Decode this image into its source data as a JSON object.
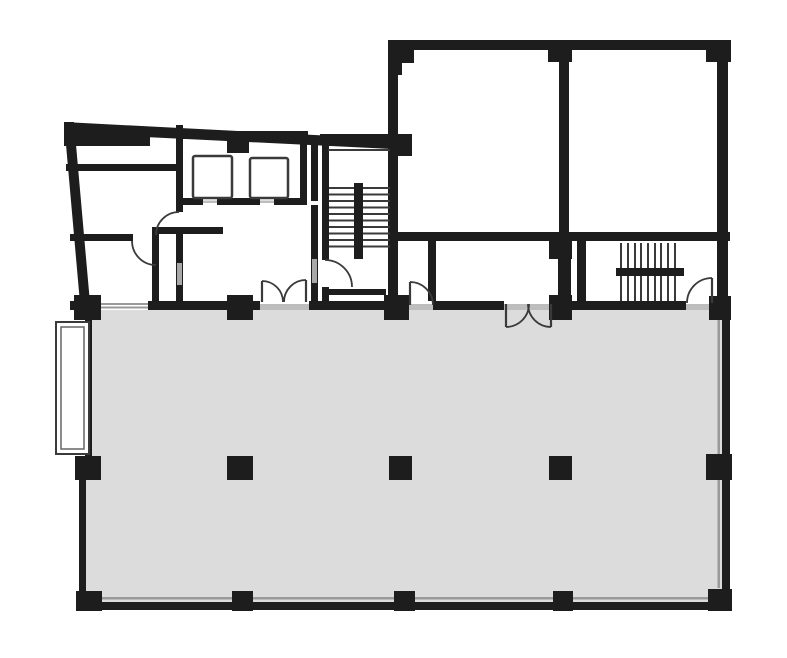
{
  "app": {
    "type": "architectural-floor-plan",
    "description": "Black-and-white building floor plan: upper room block with elevator core and two stairwells, large gray open-plan area below with structural column grid, door swing arcs and a bay window"
  },
  "canvas": {
    "width": 787,
    "height": 658,
    "background": "#ffffff"
  },
  "palette": {
    "wall": "#1d1d1d",
    "line": "#3a3a3a",
    "floor_fill": "#dcdcdc",
    "threshold": "#bdbdbd",
    "glass": "#9a9a9a",
    "marker": "#a8a8a8",
    "white": "#ffffff"
  },
  "plan": {
    "open_area": {
      "points": "88,303 728,303 728,607 80,607 80,470 88,468"
    },
    "slant_walls": [
      {
        "name": "exterior-top-left-wall",
        "points": "64,122 392,139 392,149 64,133"
      },
      {
        "name": "exterior-left-wall",
        "points": "64,122 74,122 90,303 80,303"
      }
    ],
    "walls": [
      [
        66,
        164,
        112,
        7
      ],
      [
        70,
        234,
        63,
        7
      ],
      [
        156,
        227,
        67,
        7
      ],
      [
        152,
        227,
        7,
        76
      ],
      [
        176,
        125,
        7,
        87
      ],
      [
        176,
        234,
        7,
        69
      ],
      [
        176,
        131,
        132,
        8
      ],
      [
        300,
        139,
        7,
        62
      ],
      [
        311,
        139,
        7,
        62
      ],
      [
        178,
        198,
        129,
        7
      ],
      [
        311,
        205,
        7,
        98
      ],
      [
        322,
        134,
        7,
        126
      ],
      [
        322,
        287,
        7,
        16
      ],
      [
        320,
        134,
        78,
        9
      ],
      [
        325,
        289,
        61,
        6
      ],
      [
        388,
        40,
        342,
        10
      ],
      [
        388,
        40,
        10,
        201
      ],
      [
        559,
        40,
        10,
        201
      ],
      [
        717,
        40,
        11,
        263
      ],
      [
        388,
        232,
        342,
        9
      ],
      [
        388,
        239,
        10,
        64
      ],
      [
        428,
        239,
        8,
        64
      ],
      [
        558,
        239,
        13,
        64
      ],
      [
        577,
        239,
        9,
        64
      ],
      [
        70,
        301,
        661,
        9
      ],
      [
        78,
        602,
        653,
        8
      ],
      [
        722,
        303,
        8,
        305
      ],
      [
        85,
        303,
        7,
        165
      ],
      [
        79,
        468,
        7,
        140
      ]
    ],
    "columns": [
      [
        64,
        124,
        27,
        21
      ],
      [
        64,
        132,
        86,
        14
      ],
      [
        227,
        133,
        22,
        20
      ],
      [
        388,
        134,
        24,
        22
      ],
      [
        388,
        40,
        26,
        23
      ],
      [
        388,
        40,
        14,
        35
      ],
      [
        548,
        40,
        24,
        22
      ],
      [
        706,
        40,
        25,
        22
      ],
      [
        549,
        239,
        23,
        20
      ],
      [
        74,
        295,
        27,
        25
      ],
      [
        227,
        295,
        26,
        25
      ],
      [
        384,
        295,
        25,
        25
      ],
      [
        549,
        295,
        23,
        25
      ],
      [
        709,
        296,
        22,
        24
      ],
      [
        75,
        456,
        26,
        24
      ],
      [
        227,
        456,
        26,
        24
      ],
      [
        389,
        456,
        23,
        24
      ],
      [
        549,
        456,
        23,
        24
      ],
      [
        706,
        454,
        26,
        26
      ],
      [
        76,
        591,
        26,
        20
      ],
      [
        232,
        591,
        21,
        20
      ],
      [
        394,
        591,
        21,
        20
      ],
      [
        553,
        591,
        20,
        20
      ],
      [
        708,
        589,
        24,
        22
      ]
    ],
    "gaps": [
      [
        97,
        301,
        51,
        9
      ],
      [
        260,
        301,
        49,
        9
      ],
      [
        409,
        301,
        24,
        9
      ],
      [
        504,
        301,
        48,
        9
      ],
      [
        686,
        301,
        27,
        9
      ],
      [
        203,
        198,
        14,
        7
      ],
      [
        260,
        198,
        14,
        7
      ]
    ],
    "glass_lines": [
      [
        97,
        303,
        51,
        2
      ],
      [
        97,
        306.5,
        51,
        2
      ],
      [
        100,
        597,
        615,
        2.5
      ],
      [
        717.5,
        320,
        2.5,
        268
      ]
    ],
    "thresholds": [
      [
        260,
        304,
        49,
        6
      ],
      [
        409,
        304,
        24,
        6
      ],
      [
        504,
        304,
        48,
        6
      ],
      [
        686,
        304,
        27,
        6
      ],
      [
        203,
        200.5,
        14,
        2.5
      ],
      [
        260,
        200.5,
        14,
        2.5
      ]
    ],
    "markers": [
      [
        177,
        263,
        5,
        22
      ],
      [
        312,
        259,
        5,
        24
      ]
    ],
    "elevators": [
      [
        193,
        156,
        39,
        42
      ],
      [
        250,
        158,
        38,
        40
      ]
    ],
    "stair_horizontal": {
      "x1": 329,
      "x2": 390,
      "tread_ys": [
        188,
        194.5,
        201,
        207.5,
        214,
        220.5,
        227,
        233.5,
        240,
        246.5
      ],
      "rail": [
        354,
        183,
        9,
        76
      ],
      "top_line": [
        328,
        149,
        62,
        2
      ]
    },
    "stair_vertical": {
      "y1": 243,
      "y2": 301,
      "tread_xs": [
        621,
        628,
        635,
        641,
        648,
        655,
        661,
        668,
        675
      ],
      "rail": [
        616,
        268,
        68,
        8
      ]
    },
    "doors": [
      {
        "arc": "M132,241 A24,24 0 0 0 156,265"
      },
      {
        "arc": "M179,212 A23,23 0 0 0 156,235"
      },
      {
        "arc": "M325,260 A27,27 0 0 1 352,287"
      },
      {
        "arc": "M262,281 A21,21 0 0 1 283,302",
        "leaf": "M262,302 L262,281"
      },
      {
        "arc": "M306,280 A22,22 0 0 0 284,302",
        "leaf": "M306,302 L306,280"
      },
      {
        "arc": "M506,327 A23,23 0 0 0 529,304",
        "leaf": "M506,304 L506,327"
      },
      {
        "arc": "M551,327 A23,23 0 0 1 528,304",
        "leaf": "M551,304 L551,327"
      },
      {
        "arc": "M410,282 A23,23 0 0 1 433,305",
        "leaf": "M410,305 L410,282"
      },
      {
        "arc": "M712,278 A25,25 0 0 0 687,303",
        "leaf": "M712,303 L712,278"
      }
    ],
    "bay_window": {
      "outer": [
        56,
        322,
        33,
        132
      ],
      "inner": [
        61,
        327,
        23,
        122
      ]
    }
  }
}
